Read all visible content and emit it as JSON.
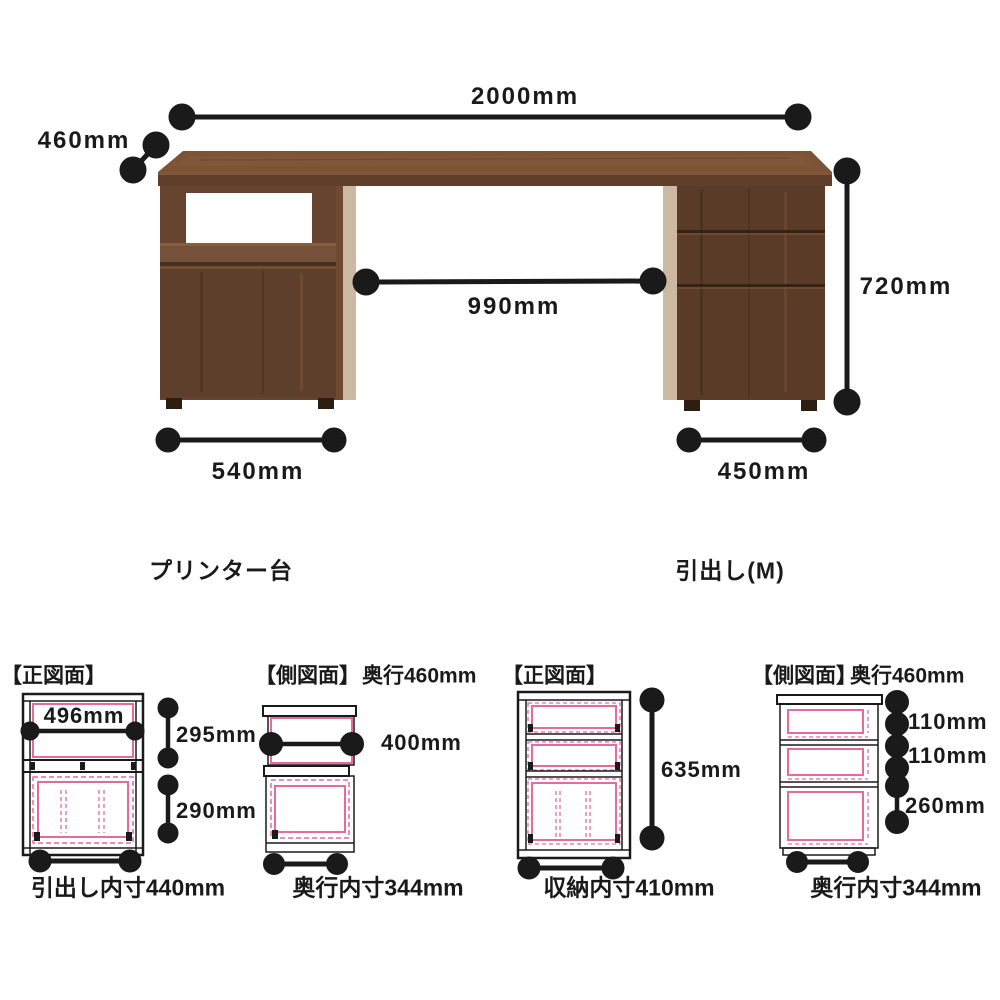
{
  "product_view": {
    "overall_width": "2000mm",
    "depth": "460mm",
    "height": "720mm",
    "knee_clearance": "990mm",
    "left_cabinet_width": "540mm",
    "right_cabinet_width": "450mm",
    "left_cabinet_label": "プリンター台",
    "right_cabinet_label": "引出し(M)"
  },
  "detail_diagrams": {
    "printer_front": {
      "header": "【正図面】",
      "shelf_inner_width": "496mm",
      "shelf_inner_height": "295mm",
      "drawer_inner_height": "290mm",
      "bottom_label": "引出し内寸440mm"
    },
    "printer_side": {
      "header": "【側図面】",
      "depth_note": "奥行460mm",
      "shelf_inner_depth": "400mm",
      "bottom_label": "奥行内寸344mm"
    },
    "drawer_front": {
      "header": "【正図面】",
      "inner_height": "635mm",
      "bottom_label": "収納内寸410mm"
    },
    "drawer_side": {
      "header": "【側図面】",
      "depth_note": "奥行460mm",
      "top_drawer_height": "110mm",
      "middle_drawer_height": "110mm",
      "bottom_drawer_height": "260mm",
      "bottom_label": "奥行内寸344mm"
    }
  },
  "colors": {
    "line": "#1a1a1a",
    "accent_pink": "#e56a9f",
    "wood_top": "#7c5335",
    "wood_face": "#5e3f2b",
    "wood_side_light": "#cbbaa1",
    "background": "#ffffff"
  }
}
